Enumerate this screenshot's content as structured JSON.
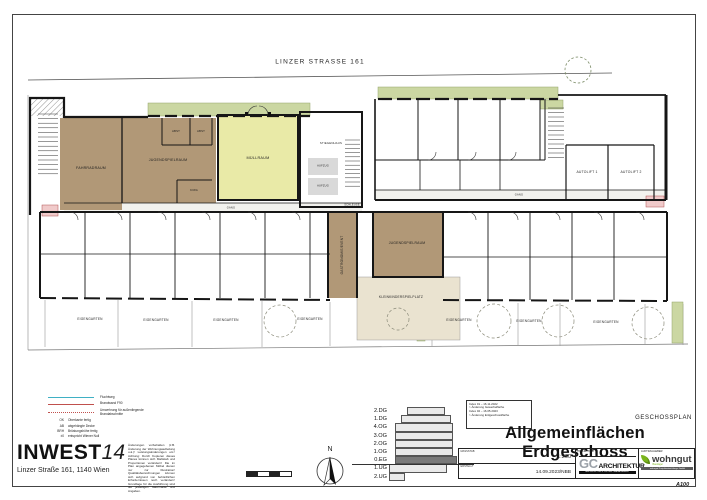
{
  "site": {
    "street_label": "LINZER STRASSE 161"
  },
  "plan": {
    "rooms": {
      "fahrradraum": "FAHRRADRAUM",
      "jugendspielraum1": "JUGENDSPIELRAUM",
      "abst1": "ABST",
      "abst2": "ABST",
      "kiwa": "KIWA",
      "muellraum": "MÜLLRAUM",
      "stiegenhaus": "STIEGENHAUS",
      "aufzug1": "AUFZUG",
      "aufzug2": "AUFZUG",
      "schleuse": "SCHLEUSE",
      "gang_left": "GANG",
      "gang_right": "GANG",
      "gastro_event": "GASTRONOMIE/EVENT",
      "jugendspielraum2": "JUGENDSPIELRAUM",
      "spielplatz": "KLEINKINDERSPIELPLATZ",
      "autolift1": "AUTOLIFT 1",
      "autolift2": "AUTOLIFT 2"
    },
    "gardens": [
      "EIGENGARTEN",
      "EIGENGARTEN",
      "EIGENGARTEN",
      "EIGENGARTEN",
      "EIGENGARTEN",
      "EIGENGARTEN",
      "EIGENGARTEN"
    ]
  },
  "legend": {
    "lines": [
      {
        "label": "Fluchtweg"
      },
      {
        "label": "Brandwand F90"
      },
      {
        "label": "Umwehrung für außenliegende Brandabschnitte"
      }
    ],
    "abbrs": [
      {
        "abbr": "OK",
        "label": "Oberkante fertig"
      },
      {
        "abbr": "AB",
        "label": "abgehängte Decke"
      },
      {
        "abbr": "BRH",
        "label": "Brüstungshöhe fertig"
      },
      {
        "abbr": "±0",
        "label": "entspricht Wiener Null"
      }
    ]
  },
  "brand": {
    "name": "INWEST",
    "suffix": "14",
    "address": "Linzer Straße 161, 1140 Wien"
  },
  "disclaimer": "Änderungen vorbehalten (z.B. Änderung der Wohnungsaufteilung u.ä.)! Leistungsänderungen etc.! Achtung: Durch Kopieren dieses Planes können sich Maßstab und Proportionen verändern! Die im Plan angegebenen Möbel dienen nur zur Illustration! Qualitätsbezeichnungen können sich aufgrund von behördlichen Erfordernissen noch verändern! Grundlage für die Ausführung sind die jeweiligen Naturmaße und Angaben.",
  "north_label": "N",
  "floors": [
    "2.DG",
    "1.DG",
    "4.OG",
    "3.OG",
    "2.OG",
    "1.OG",
    "0.EG",
    "1.UG",
    "2.UG"
  ],
  "titleblock": {
    "doc_type": "GESCHOSSPLAN",
    "title": "Allgemeinflächen Erdgeschoss",
    "revisions": [
      "Index 01 – 16.11.2022",
      "> Änderung Gewerbefläche",
      "Index 02 – 16.05.2023",
      "> Änderung Erdgeschossfläche"
    ],
    "scale_label": "MASSSTAB",
    "scale_value": "1:200",
    "date_label": "ERSTELLT",
    "date_value": "14.09.2023/NBB",
    "architect_label": "PROJEKTANT",
    "client_label": "AUFTRAGGEBER",
    "gc_logo": {
      "gc": "GC",
      "architektur": "ARCHITEKTUR",
      "tagline": "ARCHITEKTUR & PROJEKTMANAGEMENT"
    },
    "wohngut_logo": {
      "name": "wohngut",
      "sub": "Bauträger",
      "tagline": "wohngut Projektentwicklungs GmbH"
    },
    "sheet_code": "A100"
  },
  "colors": {
    "common_room_brown": "#b19877",
    "muellraum_yellow": "#e9eaa7",
    "green_planting": "#cbd7a2",
    "playground_beige": "#eae3d0",
    "marker_pink": "#f0caca",
    "current_floor_gray": "#7a7a7a"
  }
}
